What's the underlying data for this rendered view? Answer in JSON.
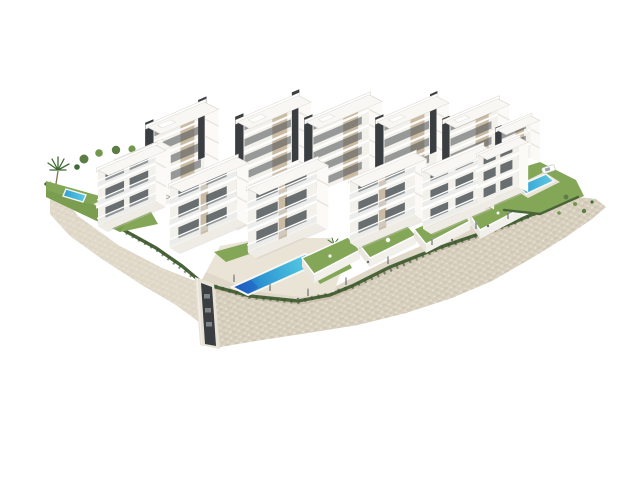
{
  "scene": {
    "type": "architectural-3d-render",
    "description": "Aerial oblique render of a white modern residential hillside complex with terraced private gardens, three swimming pools, palm trees and a beige stone retaining wall, isolated on a white background",
    "counts": {
      "building_blocks": 13,
      "swimming_pools": 3,
      "palm_trees": 2,
      "parked_cars": 1,
      "private_gardens": 4
    }
  },
  "colors": {
    "background": "#ffffff",
    "facade_light": "#f3f1ec",
    "facade_bright": "#fbfaf7",
    "roof_white": "#f8f7f3",
    "roof_edge": "#d9d6cf",
    "panel_beige": "#c7b69d",
    "core_dark": "#3a3e41",
    "window_dark": "#4a5054",
    "glass_tint": "#b9c7cb",
    "lawn_green": "#83a757",
    "lawn_dark": "#6e9248",
    "hedge_green": "#4a643a",
    "tree_green": "#5d7d46",
    "tree_green_light": "#72974e",
    "palm_green": "#3f6b34",
    "trunk_brown": "#8a7a5c",
    "wall_stone": "#d9d1c0",
    "wall_stone_dark": "#c6bba6",
    "wall_stone_light": "#e9e3d6",
    "paving": "#e0d9ca",
    "deck": "#eae4d7",
    "concrete": "#e8e3d7",
    "pool_deep": "#1d5cc2",
    "pool_mid": "#2f97d2",
    "pool_light": "#69d2e6",
    "pool_small_dark": "#2f9fd4",
    "pool_small_light": "#5fc9e2",
    "shadow_grey": "#cdc9c0",
    "car_white": "#ffffff"
  }
}
